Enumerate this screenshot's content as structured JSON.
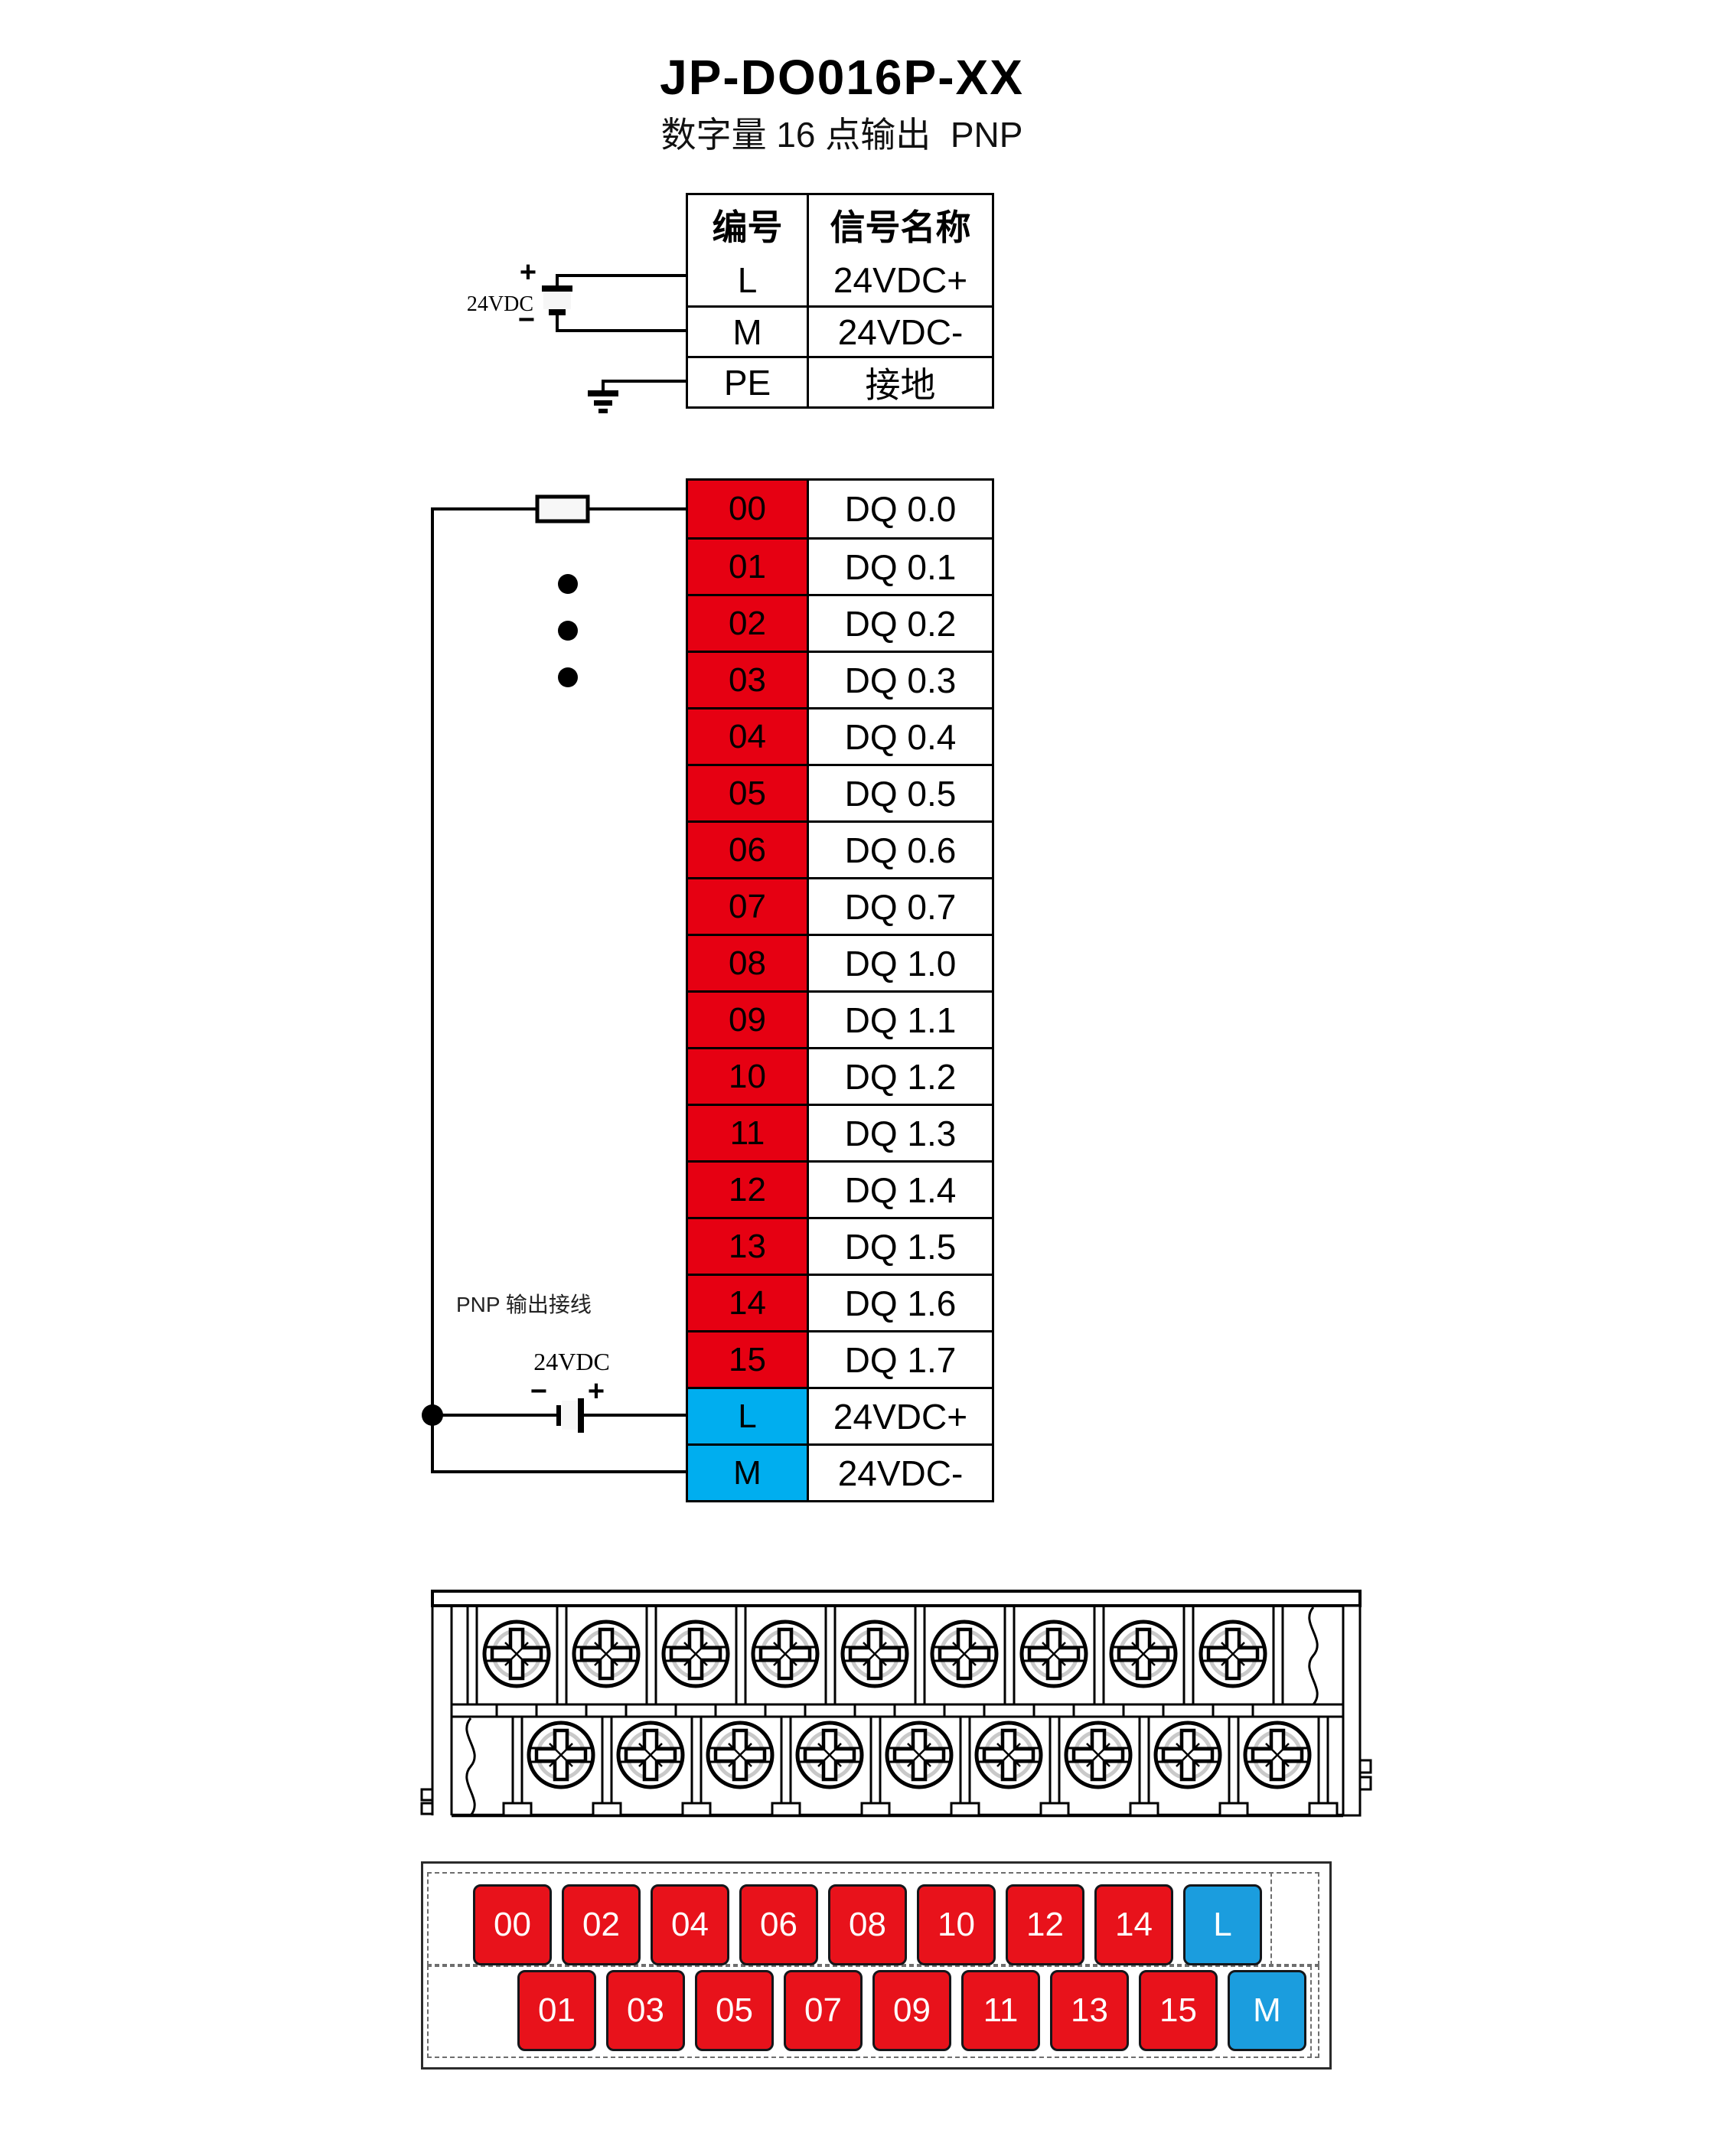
{
  "title": "JP-DO016P-XX",
  "subtitle": "数字量 16 点输出  PNP",
  "colors": {
    "signal_red": "#E60012",
    "signal_blue": "#00AEEF",
    "block_red": "#E8121B",
    "block_blue": "#1B9DDE"
  },
  "info_table": {
    "col_number": "编号",
    "col_signal": "信号名称",
    "rows": [
      {
        "num": "L",
        "name": "24VDC+"
      },
      {
        "num": "M",
        "name": "24VDC-"
      },
      {
        "num": "PE",
        "name": "接地"
      }
    ]
  },
  "top_power": {
    "label": "24VDC",
    "plus": "+",
    "minus": "−"
  },
  "main_table": {
    "rows": [
      {
        "num": "00",
        "name": "DQ 0.0",
        "color": "red"
      },
      {
        "num": "01",
        "name": "DQ 0.1",
        "color": "red"
      },
      {
        "num": "02",
        "name": "DQ 0.2",
        "color": "red"
      },
      {
        "num": "03",
        "name": "DQ 0.3",
        "color": "red"
      },
      {
        "num": "04",
        "name": "DQ 0.4",
        "color": "red"
      },
      {
        "num": "05",
        "name": "DQ 0.5",
        "color": "red"
      },
      {
        "num": "06",
        "name": "DQ 0.6",
        "color": "red"
      },
      {
        "num": "07",
        "name": "DQ 0.7",
        "color": "red"
      },
      {
        "num": "08",
        "name": "DQ 1.0",
        "color": "red"
      },
      {
        "num": "09",
        "name": "DQ 1.1",
        "color": "red"
      },
      {
        "num": "10",
        "name": "DQ 1.2",
        "color": "red"
      },
      {
        "num": "11",
        "name": "DQ 1.3",
        "color": "red"
      },
      {
        "num": "12",
        "name": "DQ 1.4",
        "color": "red"
      },
      {
        "num": "13",
        "name": "DQ 1.5",
        "color": "red"
      },
      {
        "num": "14",
        "name": "DQ 1.6",
        "color": "red"
      },
      {
        "num": "15",
        "name": "DQ 1.7",
        "color": "red"
      },
      {
        "num": "L",
        "name": "24VDC+",
        "color": "blue"
      },
      {
        "num": "M",
        "name": "24VDC-",
        "color": "blue"
      }
    ]
  },
  "bottom_power": {
    "note": "PNP 输出接线",
    "label": "24VDC",
    "plus": "+",
    "minus": "−"
  },
  "terminal_layout": {
    "top_row": [
      {
        "label": "00",
        "color": "red"
      },
      {
        "label": "02",
        "color": "red"
      },
      {
        "label": "04",
        "color": "red"
      },
      {
        "label": "06",
        "color": "red"
      },
      {
        "label": "08",
        "color": "red"
      },
      {
        "label": "10",
        "color": "red"
      },
      {
        "label": "12",
        "color": "red"
      },
      {
        "label": "14",
        "color": "red"
      },
      {
        "label": "L",
        "color": "blue"
      }
    ],
    "bottom_row": [
      {
        "label": "01",
        "color": "red"
      },
      {
        "label": "03",
        "color": "red"
      },
      {
        "label": "05",
        "color": "red"
      },
      {
        "label": "07",
        "color": "red"
      },
      {
        "label": "09",
        "color": "red"
      },
      {
        "label": "11",
        "color": "red"
      },
      {
        "label": "13",
        "color": "red"
      },
      {
        "label": "15",
        "color": "red"
      },
      {
        "label": "M",
        "color": "blue"
      }
    ]
  }
}
